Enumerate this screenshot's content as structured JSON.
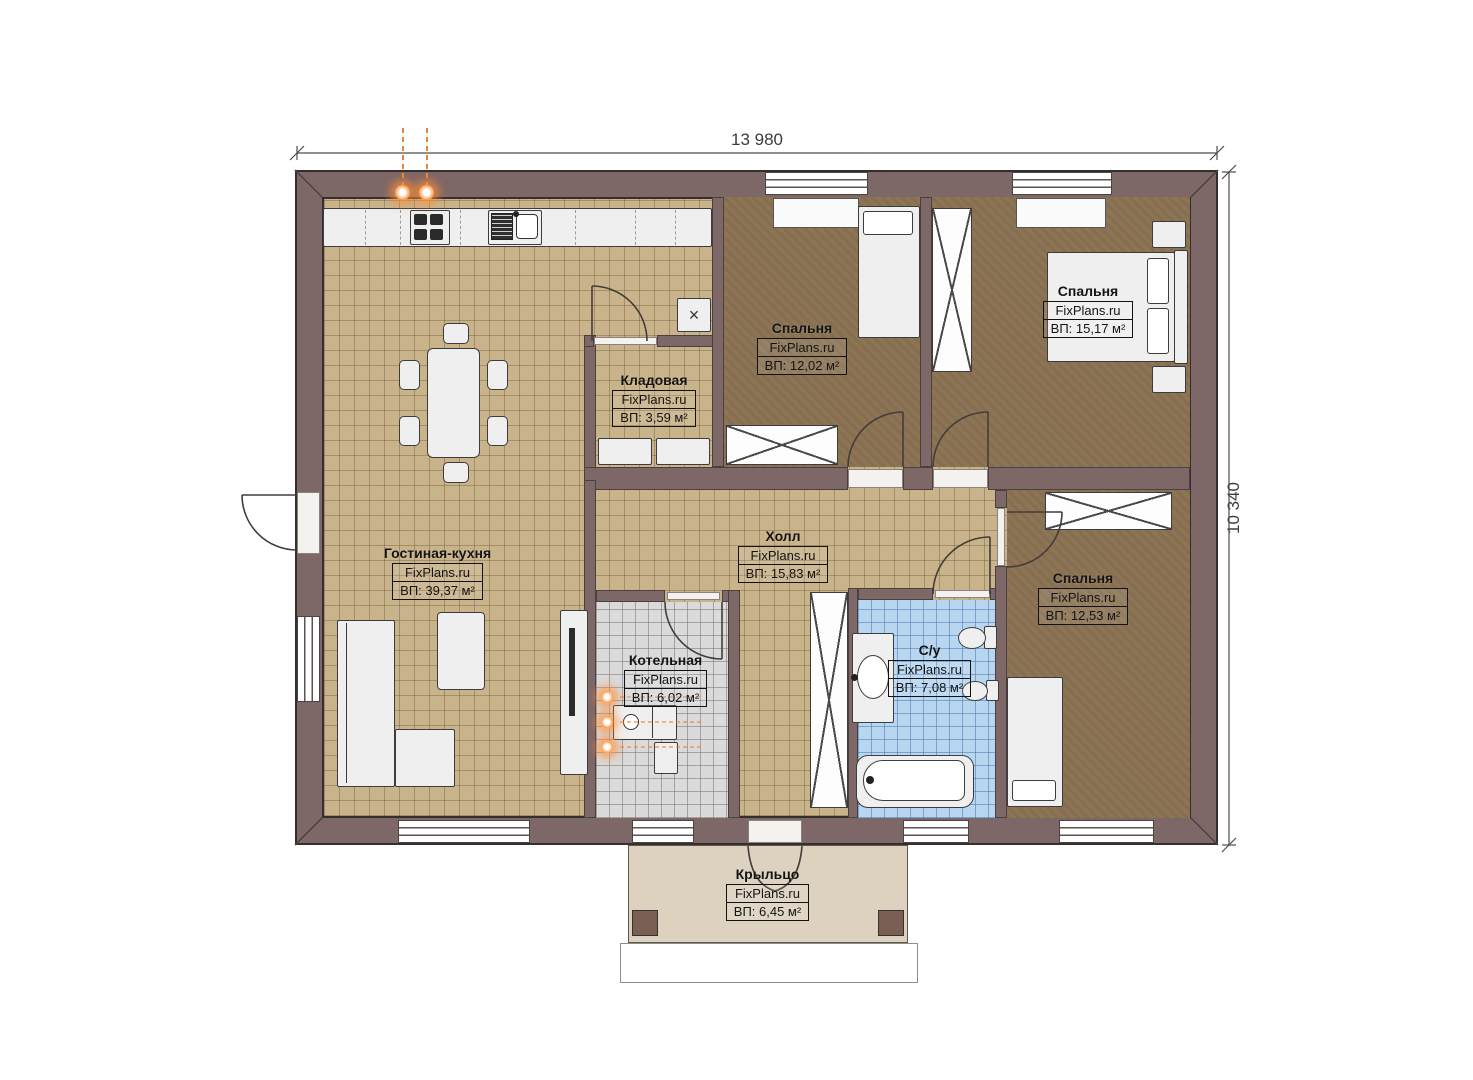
{
  "plan": {
    "watermark": "FixPlans.ru",
    "dimensions": {
      "width_label": "13 980",
      "height_label": "10 340"
    },
    "rooms": [
      {
        "id": "living-kitchen",
        "name": "Гостиная-кухня",
        "area_label": "ВП: 39,37 м²"
      },
      {
        "id": "pantry",
        "name": "Кладовая",
        "area_label": "ВП: 3,59 м²"
      },
      {
        "id": "bedroom-top-middle",
        "name": "Спальня",
        "area_label": "ВП: 12,02 м²"
      },
      {
        "id": "bedroom-top-right",
        "name": "Спальня",
        "area_label": "ВП: 15,17 м²"
      },
      {
        "id": "hall",
        "name": "Холл",
        "area_label": "ВП: 15,83 м²"
      },
      {
        "id": "boiler-room",
        "name": "Котельная",
        "area_label": "ВП: 6,02 м²"
      },
      {
        "id": "bathroom",
        "name": "С/у",
        "area_label": "ВП: 7,08 м²"
      },
      {
        "id": "bedroom-bottom-right",
        "name": "Спальня",
        "area_label": "ВП: 12,53 м²"
      },
      {
        "id": "porch",
        "name": "Крыльцо",
        "area_label": "ВП: 6,45 м²"
      }
    ],
    "icons": {
      "vent": "×"
    },
    "colors": {
      "wall": "#7d6767",
      "floor_tile": "#c9b38a",
      "floor_bedroom": "#8c7455",
      "floor_bath": "#b9d6f0",
      "floor_boiler": "#dadada",
      "porch": "#ddd2bf",
      "accent_orange": "#f08030"
    }
  }
}
